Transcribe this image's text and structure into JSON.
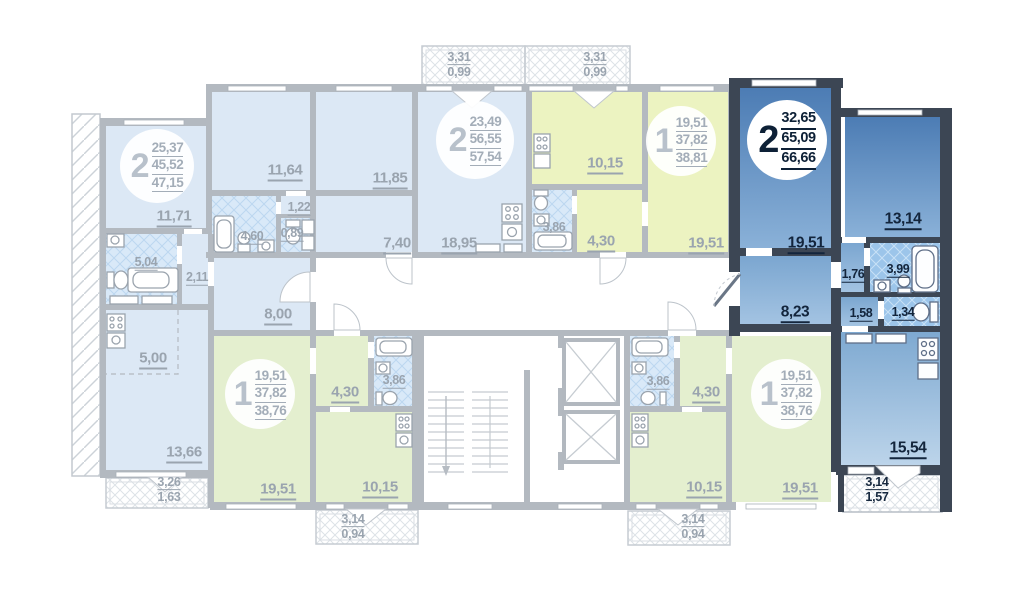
{
  "plan_title": "Floor plan with highlighted 2-room apartment",
  "colors": {
    "wall": "#b3b9c0",
    "wall_highlight": "#3c4654",
    "unit_dim_blue": "#dce8f5",
    "unit_yellow": "#ecf3c1",
    "unit_green": "#e4efcf",
    "unit_active_top": "#4c7cb4",
    "unit_active_bottom": "#9cbede",
    "label_dim": "#9aa4af",
    "label_active": "#13253c",
    "tile_dim": "#d9e9f8",
    "tile_active": "#9cc5ea"
  },
  "icons": [
    "bathtub-icon",
    "toilet-icon",
    "sink-icon",
    "stove-icon",
    "stairs-icon",
    "elevator-icon"
  ],
  "apartments": [
    {
      "id": "left-2-room",
      "rooms_count": "2",
      "highlighted": false,
      "living_area": "25,37",
      "area": "45,52",
      "total_area": "47,15",
      "rooms": {
        "room1": "11,71",
        "bath": "5,04",
        "corridor": "2,11",
        "hall": "8,00",
        "kitchen": "5,00",
        "room2": "13,66"
      },
      "balcony": {
        "width": "3,26",
        "area": "1,63"
      }
    },
    {
      "id": "middle-2-room",
      "rooms_count": "2",
      "highlighted": false,
      "living_area": "23,49",
      "area": "56,55",
      "total_area": "57,54",
      "rooms": {
        "room1": "11,64",
        "corridor": "1,22",
        "bath": "4,60",
        "wc": "0,89",
        "room2": "11,85",
        "hall": "7,40",
        "kitchen_living": "18,95"
      },
      "balcony": {
        "width": "3,31",
        "area": "0,99"
      }
    },
    {
      "id": "top-right-1-room",
      "rooms_count": "1",
      "highlighted": false,
      "living_area": "19,51",
      "area": "37,82",
      "total_area": "38,81",
      "rooms": {
        "kitchen": "10,15",
        "bath": "3,86",
        "hall": "4,30",
        "room": "19,51"
      },
      "balcony": {
        "width": "3,31",
        "area": "0,99"
      }
    },
    {
      "id": "highlighted-2-room",
      "rooms_count": "2",
      "highlighted": true,
      "living_area": "32,65",
      "area": "65,09",
      "total_area": "66,66",
      "rooms": {
        "room1": "19,51",
        "room2": "13,14",
        "corridor1": "1,76",
        "bath": "3,99",
        "corridor2": "1,58",
        "wc": "1,34",
        "hall": "8,23",
        "kitchen_living": "15,54"
      },
      "balcony": {
        "width": "3,14",
        "area": "1,57"
      }
    },
    {
      "id": "bottom-left-1-room",
      "rooms_count": "1",
      "highlighted": false,
      "living_area": "19,51",
      "area": "37,82",
      "total_area": "38,76",
      "rooms": {
        "room": "19,51",
        "hall": "4,30",
        "bath": "3,86",
        "kitchen": "10,15"
      },
      "balcony": {
        "width": "3,14",
        "area": "0,94"
      }
    },
    {
      "id": "bottom-right-1-room",
      "rooms_count": "1",
      "highlighted": false,
      "living_area": "19,51",
      "area": "37,82",
      "total_area": "38,76",
      "rooms": {
        "bath": "3,86",
        "hall": "4,30",
        "kitchen": "10,15",
        "room": "19,51"
      },
      "balcony": {
        "width": "3,14",
        "area": "0,94"
      }
    }
  ]
}
